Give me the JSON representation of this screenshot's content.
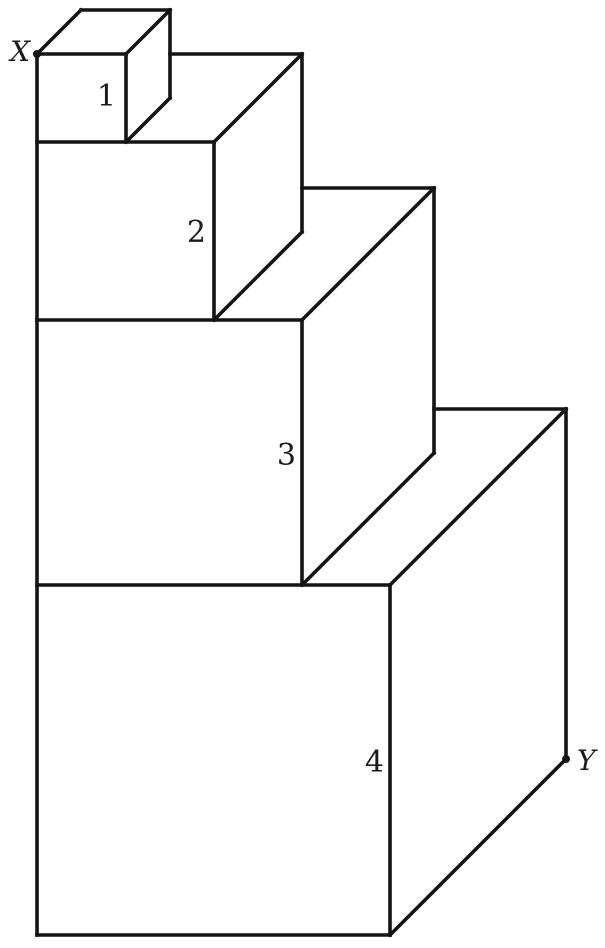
{
  "figure": {
    "background": "#ffffff",
    "stroke_color": "#141414",
    "stroke_width": 3.6,
    "label_color": "#1c1c1c",
    "point_radius": 4,
    "digit_font_size": 30,
    "point_font_size": 28,
    "width": 605,
    "height": 948
  },
  "diagram_data": {
    "type": "diagram",
    "description": "Four stacked cubes with side ratio 1:2:3:4 drawn in oblique projection, smallest cube on top. Each cube front face is labeled with its number near the front-right edge. Point X is marked with a dot at the top-front-left corner of cube 1; point Y is marked with a dot at the bottom-back-right corner of cube 4.",
    "cube_labels": [
      "1",
      "2",
      "3",
      "4"
    ],
    "point_labels": [
      "X",
      "Y"
    ],
    "points": [
      {
        "name": "point-x-marker",
        "label": "X",
        "x": 37,
        "y": 54
      },
      {
        "name": "point-y-marker",
        "label": "Y",
        "x": 566,
        "y": 759
      }
    ],
    "texts": [
      {
        "name": "label-point-x",
        "text": "X",
        "x": 30,
        "y": 61,
        "anchor": "end",
        "italic": true
      },
      {
        "name": "label-point-y",
        "text": "Y",
        "x": 577,
        "y": 770,
        "anchor": "start",
        "italic": true
      },
      {
        "name": "label-cube-1",
        "text": "1",
        "x": 116,
        "y": 106,
        "anchor": "end",
        "italic": false
      },
      {
        "name": "label-cube-2",
        "text": "2",
        "x": 206,
        "y": 242,
        "anchor": "end",
        "italic": false
      },
      {
        "name": "label-cube-3",
        "text": "3",
        "x": 296,
        "y": 465,
        "anchor": "end",
        "italic": false
      },
      {
        "name": "label-cube-4",
        "text": "4",
        "x": 384,
        "y": 772,
        "anchor": "end",
        "italic": false
      }
    ],
    "segments": [
      {
        "name": "stack-front-left-edge",
        "x1": 37,
        "y1": 54,
        "x2": 37,
        "y2": 935
      },
      {
        "name": "cube1-front-right-edge",
        "x1": 126,
        "y1": 54,
        "x2": 126,
        "y2": 142
      },
      {
        "name": "cube2-front-right-edge",
        "x1": 214,
        "y1": 142,
        "x2": 214,
        "y2": 320
      },
      {
        "name": "cube3-front-right-edge",
        "x1": 302,
        "y1": 320,
        "x2": 302,
        "y2": 585
      },
      {
        "name": "cube4-front-right-edge",
        "x1": 390,
        "y1": 585,
        "x2": 390,
        "y2": 935
      },
      {
        "name": "cube1-top-front-edge",
        "x1": 37,
        "y1": 54,
        "x2": 126,
        "y2": 54
      },
      {
        "name": "cube2-top-front-edge",
        "x1": 37,
        "y1": 142,
        "x2": 214,
        "y2": 142
      },
      {
        "name": "cube3-top-front-edge",
        "x1": 37,
        "y1": 320,
        "x2": 302,
        "y2": 320
      },
      {
        "name": "cube4-top-front-edge",
        "x1": 37,
        "y1": 585,
        "x2": 390,
        "y2": 585
      },
      {
        "name": "cube4-bottom-front-edge",
        "x1": 37,
        "y1": 935,
        "x2": 390,
        "y2": 935
      },
      {
        "name": "cube1-top-left-depth-edge",
        "x1": 37,
        "y1": 54,
        "x2": 81,
        "y2": 10
      },
      {
        "name": "cube1-top-back-edge",
        "x1": 81,
        "y1": 10,
        "x2": 170,
        "y2": 10
      },
      {
        "name": "cube1-top-right-depth-edge",
        "x1": 126,
        "y1": 54,
        "x2": 170,
        "y2": 10
      },
      {
        "name": "cube1-back-right-edge",
        "x1": 170,
        "y1": 10,
        "x2": 170,
        "y2": 98
      },
      {
        "name": "cube1-bottom-right-depth-edge",
        "x1": 126,
        "y1": 142,
        "x2": 170,
        "y2": 98
      },
      {
        "name": "cube2-top-back-edge",
        "x1": 170,
        "y1": 54,
        "x2": 302,
        "y2": 54
      },
      {
        "name": "cube2-top-right-depth-edge",
        "x1": 214,
        "y1": 142,
        "x2": 302,
        "y2": 54
      },
      {
        "name": "cube2-back-right-edge",
        "x1": 302,
        "y1": 54,
        "x2": 302,
        "y2": 232
      },
      {
        "name": "cube2-bottom-right-depth-edge",
        "x1": 214,
        "y1": 320,
        "x2": 302,
        "y2": 232
      },
      {
        "name": "cube3-top-back-edge",
        "x1": 302,
        "y1": 188,
        "x2": 434,
        "y2": 188
      },
      {
        "name": "cube3-top-right-depth-edge",
        "x1": 302,
        "y1": 320,
        "x2": 434,
        "y2": 188
      },
      {
        "name": "cube3-back-right-edge",
        "x1": 434,
        "y1": 188,
        "x2": 434,
        "y2": 453
      },
      {
        "name": "cube3-bottom-right-depth-edge",
        "x1": 302,
        "y1": 585,
        "x2": 434,
        "y2": 453
      },
      {
        "name": "cube4-top-back-edge",
        "x1": 434,
        "y1": 409,
        "x2": 566,
        "y2": 409
      },
      {
        "name": "cube4-top-right-depth-edge",
        "x1": 390,
        "y1": 585,
        "x2": 566,
        "y2": 409
      },
      {
        "name": "cube4-back-right-edge",
        "x1": 566,
        "y1": 409,
        "x2": 566,
        "y2": 759
      },
      {
        "name": "cube4-bottom-right-depth-edge",
        "x1": 390,
        "y1": 935,
        "x2": 566,
        "y2": 759
      }
    ]
  }
}
